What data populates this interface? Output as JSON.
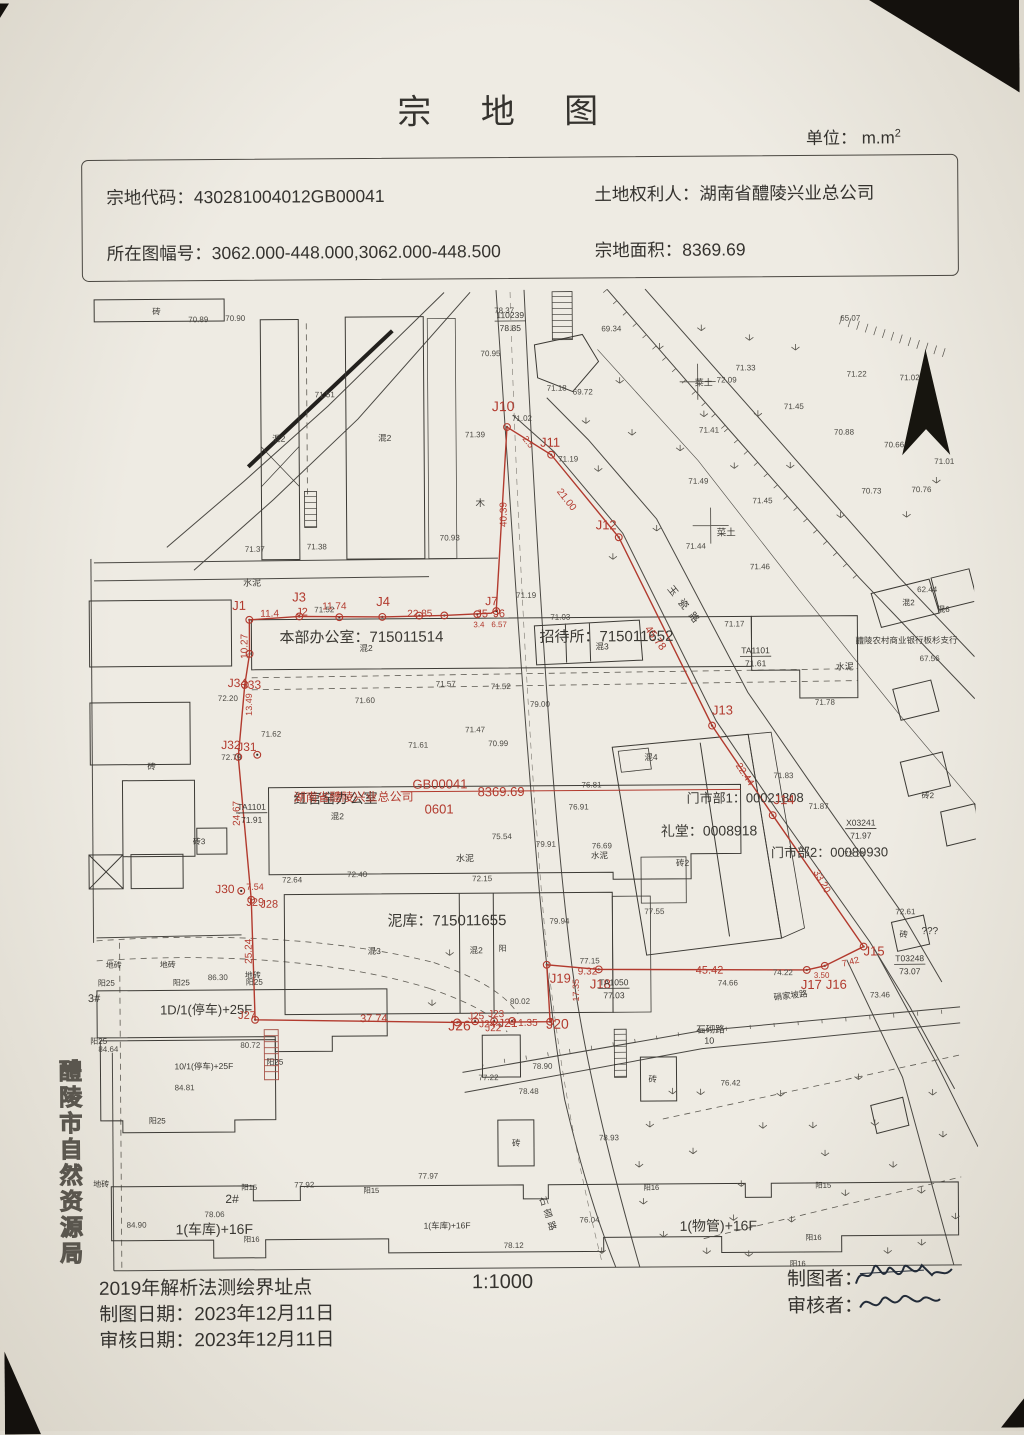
{
  "header": {
    "title": "宗 地 图",
    "unit_label": "单位： m.m",
    "unit_sup": "2"
  },
  "info": {
    "parcel_code_label": "宗地代码：",
    "parcel_code": "430281004012GB00041",
    "owner_label": "土地权利人：",
    "owner": "湖南省醴陵兴业总公司",
    "sheet_label": "所在图幅号：",
    "sheet": "3062.000-448.000,3062.000-448.500",
    "area_label": "宗地面积：",
    "area": "8369.69"
  },
  "footer": {
    "method": "2019年解析法测绘界址点",
    "scale": "1:1000",
    "drafter_label": "制图者：",
    "reviewer_label": "审核者：",
    "draft_date_label": "制图日期：",
    "draft_date": "2023年12月11日",
    "review_date_label": "审核日期：",
    "review_date": "2023年12月11日"
  },
  "side_label": "醴陵市自然资源局",
  "map": {
    "red_color": "#b23a2e",
    "ink_color": "#3a3833",
    "black_labels": [
      {
        "t": "本部办公室：715011514",
        "x": 280,
        "y": 641,
        "fs": 15
      },
      {
        "t": "招待所：715011652",
        "x": 540,
        "y": 642,
        "fs": 15
      },
      {
        "t": "红官窑办公室",
        "x": 293,
        "y": 802,
        "fs": 14
      },
      {
        "t": "泥库：715011655",
        "x": 386,
        "y": 925,
        "fs": 15
      },
      {
        "t": "门市部1：00021808",
        "x": 686,
        "y": 804,
        "fs": 13
      },
      {
        "t": "礼堂：0008918",
        "x": 660,
        "y": 837,
        "fs": 14
      },
      {
        "t": "门市部2：00089930",
        "x": 770,
        "y": 859,
        "fs": 13
      },
      {
        "t": "醴陵农村商业银行板杉支行",
        "x": 856,
        "y": 646,
        "fs": 8.5
      },
      {
        "t": "石砌路",
        "x": 694,
        "y": 1034,
        "fs": 9.5
      },
      {
        "t": "10",
        "x": 702,
        "y": 1045,
        "fs": 9
      },
      {
        "t": "硝家坡路",
        "x": 772,
        "y": 1002,
        "fs": 8.5,
        "rot": -6
      },
      {
        "t": "玉瓷路",
        "x": 668,
        "y": 590,
        "fs": 10,
        "rot": 52,
        "ls": 7
      },
      {
        "t": "石砌路",
        "x": 536,
        "y": 1198,
        "fs": 9,
        "rot": 72,
        "ls": 4
      },
      {
        "t": "菜土",
        "x": 718,
        "y": 537,
        "fs": 9.5
      },
      {
        "t": "菜土",
        "x": 697,
        "y": 387,
        "fs": 9
      },
      {
        "t": "混2",
        "x": 274,
        "y": 440,
        "fs": 8.5
      },
      {
        "t": "混2",
        "x": 380,
        "y": 440,
        "fs": 8.5
      },
      {
        "t": "混2",
        "x": 360,
        "y": 650,
        "fs": 8.5
      },
      {
        "t": "混3",
        "x": 596,
        "y": 650,
        "fs": 8.5
      },
      {
        "t": "混2",
        "x": 330,
        "y": 818,
        "fs": 8.5
      },
      {
        "t": "混3",
        "x": 366,
        "y": 953,
        "fs": 8.5
      },
      {
        "t": "混2",
        "x": 468,
        "y": 953,
        "fs": 8.5
      },
      {
        "t": "阳",
        "x": 497,
        "y": 951,
        "fs": 8
      },
      {
        "t": "混4",
        "x": 644,
        "y": 761,
        "fs": 8.5
      },
      {
        "t": "砖2",
        "x": 675,
        "y": 867,
        "fs": 8.5
      },
      {
        "t": "混2",
        "x": 903,
        "y": 608,
        "fs": 8
      },
      {
        "t": "混6",
        "x": 938,
        "y": 615,
        "fs": 8
      },
      {
        "t": "砖2",
        "x": 921,
        "y": 801,
        "fs": 8
      },
      {
        "t": "水泥",
        "x": 244,
        "y": 584,
        "fs": 9
      },
      {
        "t": "水泥",
        "x": 836,
        "y": 672,
        "fs": 9
      },
      {
        "t": "水泥",
        "x": 455,
        "y": 861,
        "fs": 9
      },
      {
        "t": "水泥",
        "x": 590,
        "y": 859,
        "fs": 8.5
      },
      {
        "t": "木",
        "x": 477,
        "y": 506,
        "fs": 9.5
      },
      {
        "t": "地砖",
        "x": 104,
        "y": 965,
        "fs": 8
      },
      {
        "t": "地砖",
        "x": 158,
        "y": 965,
        "fs": 8
      },
      {
        "t": "地砖",
        "x": 243,
        "y": 976,
        "fs": 8
      },
      {
        "t": "地砖",
        "x": 90,
        "y": 1184,
        "fs": 8
      },
      {
        "t": "阳25",
        "x": 96,
        "y": 983,
        "fs": 8
      },
      {
        "t": "阳25",
        "x": 171,
        "y": 983,
        "fs": 8
      },
      {
        "t": "阳25",
        "x": 244,
        "y": 983,
        "fs": 8
      },
      {
        "t": "阳25",
        "x": 88,
        "y": 1041,
        "fs": 8
      },
      {
        "t": "阳25",
        "x": 264,
        "y": 1063,
        "fs": 8
      },
      {
        "t": "阳25",
        "x": 146,
        "y": 1121,
        "fs": 8
      },
      {
        "t": "3#",
        "x": 86,
        "y": 999,
        "fs": 11
      },
      {
        "t": "1D/1(停车)+25F",
        "x": 158,
        "y": 1012,
        "fs": 13
      },
      {
        "t": "10/1(停车)+25F",
        "x": 172,
        "y": 1067,
        "fs": 8.5
      },
      {
        "t": "2#",
        "x": 222,
        "y": 1201,
        "fs": 12
      },
      {
        "t": "1(车库)+16F",
        "x": 172,
        "y": 1232,
        "fs": 14
      },
      {
        "t": "1(车库)+16F",
        "x": 420,
        "y": 1228,
        "fs": 8.5
      },
      {
        "t": "1(物管)+16F",
        "x": 676,
        "y": 1232,
        "fs": 14
      },
      {
        "t": "阳15",
        "x": 238,
        "y": 1188,
        "fs": 7.5
      },
      {
        "t": "阳15",
        "x": 360,
        "y": 1192,
        "fs": 7.5
      },
      {
        "t": "阳16",
        "x": 640,
        "y": 1191,
        "fs": 7.5
      },
      {
        "t": "阳15",
        "x": 812,
        "y": 1190,
        "fs": 7.5
      },
      {
        "t": "阳16",
        "x": 240,
        "y": 1240,
        "fs": 7.5
      },
      {
        "t": "阳16",
        "x": 802,
        "y": 1242,
        "fs": 7.5
      },
      {
        "t": "阳16",
        "x": 786,
        "y": 1268,
        "fs": 7.5
      },
      {
        "t": "砖",
        "x": 155,
        "y": 312,
        "fs": 8.5
      },
      {
        "t": "砖",
        "x": 147,
        "y": 767,
        "fs": 8.5
      },
      {
        "t": "砖3",
        "x": 192,
        "y": 842,
        "fs": 8
      },
      {
        "t": "砖",
        "x": 646,
        "y": 1083,
        "fs": 8.5
      },
      {
        "t": "砖",
        "x": 509,
        "y": 1146,
        "fs": 8.5
      },
      {
        "t": "砖",
        "x": 898,
        "y": 940,
        "fs": 8.5
      },
      {
        "t": "???",
        "x": 920,
        "y": 937,
        "fs": 10
      }
    ],
    "red_labels": [
      {
        "t": "J10",
        "x": 494,
        "y": 411,
        "fs": 14
      },
      {
        "t": "J11",
        "x": 542,
        "y": 447,
        "fs": 13
      },
      {
        "t": "2.5",
        "x": 524,
        "y": 439,
        "fs": 9,
        "rot": 52
      },
      {
        "t": "21.00",
        "x": 558,
        "y": 492,
        "fs": 10,
        "rot": 52
      },
      {
        "t": "J12",
        "x": 597,
        "y": 530,
        "fs": 13
      },
      {
        "t": "45.78",
        "x": 645,
        "y": 630,
        "fs": 11,
        "rot": 53
      },
      {
        "t": "J13",
        "x": 712,
        "y": 716,
        "fs": 13
      },
      {
        "t": "22.44",
        "x": 735,
        "y": 767,
        "fs": 10,
        "rot": 57
      },
      {
        "t": "J14",
        "x": 773,
        "y": 806,
        "fs": 13
      },
      {
        "t": "33.20",
        "x": 812,
        "y": 874,
        "fs": 10,
        "rot": 61
      },
      {
        "t": "J15",
        "x": 862,
        "y": 958,
        "fs": 13
      },
      {
        "t": "7.42",
        "x": 841,
        "y": 969,
        "fs": 9,
        "rot": -14
      },
      {
        "t": "3.50",
        "x": 812,
        "y": 980,
        "fs": 8
      },
      {
        "t": "J17",
        "x": 799,
        "y": 991,
        "fs": 13
      },
      {
        "t": "J16",
        "x": 824,
        "y": 991,
        "fs": 13
      },
      {
        "t": "45.42",
        "x": 694,
        "y": 975,
        "fs": 11
      },
      {
        "t": "J18",
        "x": 588,
        "y": 989,
        "fs": 13
      },
      {
        "t": "9.32",
        "x": 576,
        "y": 975,
        "fs": 10
      },
      {
        "t": "J19",
        "x": 548,
        "y": 983,
        "fs": 13
      },
      {
        "t": "17.35",
        "x": 577,
        "y": 1002,
        "fs": 9,
        "rot": -90
      },
      {
        "t": "J20",
        "x": 544,
        "y": 1029,
        "fs": 14
      },
      {
        "t": "1.35",
        "x": 516,
        "y": 1026,
        "fs": 10
      },
      {
        "t": "J21",
        "x": 496,
        "y": 1027,
        "fs": 12
      },
      {
        "t": "J25",
        "x": 466,
        "y": 1019,
        "fs": 10
      },
      {
        "t": "J24",
        "x": 477,
        "y": 1027,
        "fs": 10
      },
      {
        "t": "J23",
        "x": 486,
        "y": 1017,
        "fs": 10
      },
      {
        "t": "J22",
        "x": 483,
        "y": 1031,
        "fs": 10
      },
      {
        "t": "J26",
        "x": 446,
        "y": 1030,
        "fs": 14
      },
      {
        "t": "37.74",
        "x": 358,
        "y": 1021,
        "fs": 11
      },
      {
        "t": "J27",
        "x": 236,
        "y": 1017,
        "fs": 11
      },
      {
        "t": "25.24",
        "x": 250,
        "y": 962,
        "fs": 10,
        "rot": -90
      },
      {
        "t": "J29",
        "x": 245,
        "y": 904,
        "fs": 11
      },
      {
        "t": "J28",
        "x": 259,
        "y": 906,
        "fs": 11
      },
      {
        "t": "7.54",
        "x": 245,
        "y": 888,
        "fs": 9
      },
      {
        "t": "J30",
        "x": 214,
        "y": 891,
        "fs": 12
      },
      {
        "t": "24.67",
        "x": 239,
        "y": 824,
        "fs": 10,
        "rot": -90
      },
      {
        "t": "J32",
        "x": 221,
        "y": 747,
        "fs": 12
      },
      {
        "t": "J31",
        "x": 237,
        "y": 749,
        "fs": 12
      },
      {
        "t": "13.49",
        "x": 252,
        "y": 714,
        "fs": 9,
        "rot": -90
      },
      {
        "t": "J34",
        "x": 228,
        "y": 685,
        "fs": 12
      },
      {
        "t": "J33",
        "x": 242,
        "y": 687,
        "fs": 12
      },
      {
        "t": "10.27",
        "x": 248,
        "y": 657,
        "fs": 10,
        "rot": -90
      },
      {
        "t": "J1",
        "x": 233,
        "y": 608,
        "fs": 13
      },
      {
        "t": "11.4",
        "x": 261,
        "y": 615,
        "fs": 10
      },
      {
        "t": "J3",
        "x": 293,
        "y": 600,
        "fs": 13
      },
      {
        "t": "J2",
        "x": 297,
        "y": 614,
        "fs": 11
      },
      {
        "t": "11.74",
        "x": 323,
        "y": 608,
        "fs": 10
      },
      {
        "t": "J4",
        "x": 377,
        "y": 605,
        "fs": 13
      },
      {
        "t": "22.85",
        "x": 408,
        "y": 616,
        "fs": 10
      },
      {
        "t": "J7",
        "x": 486,
        "y": 605,
        "fs": 12
      },
      {
        "t": "J5",
        "x": 477,
        "y": 617,
        "fs": 11
      },
      {
        "t": "J6",
        "x": 494,
        "y": 617,
        "fs": 11
      },
      {
        "t": "6.57",
        "x": 492,
        "y": 627,
        "fs": 8
      },
      {
        "t": "3.4",
        "x": 474,
        "y": 627,
        "fs": 8
      },
      {
        "t": "40.39",
        "x": 508,
        "y": 527,
        "fs": 10,
        "rot": -90
      },
      {
        "t": "湖南省醴陵兴业总公司",
        "x": 293,
        "y": 800,
        "fs": 12
      },
      {
        "t": "GB00041",
        "x": 412,
        "y": 788,
        "fs": 13
      },
      {
        "t": "0601",
        "x": 424,
        "y": 813,
        "fs": 13
      },
      {
        "t": "8369.69",
        "x": 477,
        "y": 796,
        "fs": 13
      }
    ],
    "elevations": [
      [
        497,
        313,
        "78.37"
      ],
      [
        483,
        356,
        "70.95"
      ],
      [
        604,
        332,
        "69.34"
      ],
      [
        549,
        391,
        "71.18"
      ],
      [
        575,
        395,
        "69.72"
      ],
      [
        514,
        421,
        "71.02"
      ],
      [
        467,
        437,
        "71.39"
      ],
      [
        560,
        462,
        "71.19"
      ],
      [
        719,
        384,
        "72.09"
      ],
      [
        701,
        434,
        "71.41"
      ],
      [
        738,
        372,
        "71.33"
      ],
      [
        843,
        323,
        "65.07"
      ],
      [
        849,
        379,
        "71.22"
      ],
      [
        902,
        383,
        "71.02"
      ],
      [
        786,
        411,
        "71.45"
      ],
      [
        836,
        437,
        "70.88"
      ],
      [
        886,
        450,
        "70.66"
      ],
      [
        936,
        467,
        "71.01"
      ],
      [
        863,
        496,
        "70.73"
      ],
      [
        913,
        495,
        "70.76"
      ],
      [
        690,
        485,
        "71.49"
      ],
      [
        754,
        505,
        "71.45"
      ],
      [
        687,
        550,
        "71.44"
      ],
      [
        751,
        571,
        "71.46"
      ],
      [
        725,
        628,
        "71.17"
      ],
      [
        517,
        598,
        "71.19"
      ],
      [
        551,
        620,
        "71.03"
      ],
      [
        436,
        686,
        "71.57"
      ],
      [
        491,
        689,
        "71.52"
      ],
      [
        355,
        702,
        "71.60"
      ],
      [
        465,
        732,
        "71.47"
      ],
      [
        408,
        747,
        "71.61"
      ],
      [
        488,
        746,
        "70.99"
      ],
      [
        315,
        611,
        "71.52"
      ],
      [
        441,
        540,
        "70.93"
      ],
      [
        246,
        550,
        "71.37"
      ],
      [
        308,
        548,
        "71.38"
      ],
      [
        191,
        320,
        "70.89"
      ],
      [
        228,
        319,
        "70.90"
      ],
      [
        317,
        396,
        "71.51"
      ],
      [
        218,
        699,
        "72.20"
      ],
      [
        261,
        735,
        "71.62"
      ],
      [
        221,
        758,
        "72.79"
      ],
      [
        281,
        881,
        "72.64"
      ],
      [
        346,
        876,
        "72.40"
      ],
      [
        471,
        881,
        "72.15"
      ],
      [
        491,
        839,
        "75.54"
      ],
      [
        568,
        810,
        "76.91"
      ],
      [
        591,
        849,
        "76.69"
      ],
      [
        581,
        788,
        "76.81"
      ],
      [
        530,
        707,
        "79.00"
      ],
      [
        535,
        847,
        "79.91"
      ],
      [
        548,
        924,
        "79.94"
      ],
      [
        578,
        964,
        "77.15"
      ],
      [
        508,
        1004,
        "80.02"
      ],
      [
        476,
        1080,
        "77.22"
      ],
      [
        530,
        1069,
        "78.90"
      ],
      [
        516,
        1094,
        "78.48"
      ],
      [
        596,
        1141,
        "78.93"
      ],
      [
        771,
        977,
        "74.22"
      ],
      [
        716,
        987,
        "74.66"
      ],
      [
        868,
        1000,
        "73.46"
      ],
      [
        894,
        917,
        "72.61"
      ],
      [
        815,
        707,
        "71.78"
      ],
      [
        920,
        664,
        "67.56"
      ],
      [
        918,
        595,
        "62.44"
      ],
      [
        773,
        780,
        "71.83"
      ],
      [
        808,
        811,
        "71.87"
      ],
      [
        843,
        859,
        "72.16"
      ],
      [
        206,
        978,
        "86.30"
      ],
      [
        96,
        1049,
        "84.64"
      ],
      [
        238,
        1046,
        "80.72"
      ],
      [
        172,
        1088,
        "84.81"
      ],
      [
        123,
        1225,
        "84.90"
      ],
      [
        291,
        1186,
        "77.92"
      ],
      [
        415,
        1178,
        "77.97"
      ],
      [
        201,
        1215,
        "78.06"
      ],
      [
        500,
        1248,
        "78.12"
      ],
      [
        718,
        1087,
        "76.42"
      ],
      [
        643,
        915,
        "77.55"
      ],
      [
        576,
        1223,
        "76.04"
      ]
    ],
    "control_points": [
      {
        "top": "110239",
        "bottom": "78.85",
        "x": 513,
        "y": 318
      },
      {
        "top": "TA1101",
        "bottom": "71.61",
        "x": 756,
        "y": 655
      },
      {
        "top": "TA1101",
        "bottom": "71.91",
        "x": 251,
        "y": 808
      },
      {
        "top": "TA1050",
        "bottom": "77.03",
        "x": 612,
        "y": 986
      },
      {
        "top": "T03248",
        "bottom": "73.07",
        "x": 908,
        "y": 964
      },
      {
        "top": "X03241",
        "bottom": "71.97",
        "x": 860,
        "y": 828
      }
    ]
  }
}
